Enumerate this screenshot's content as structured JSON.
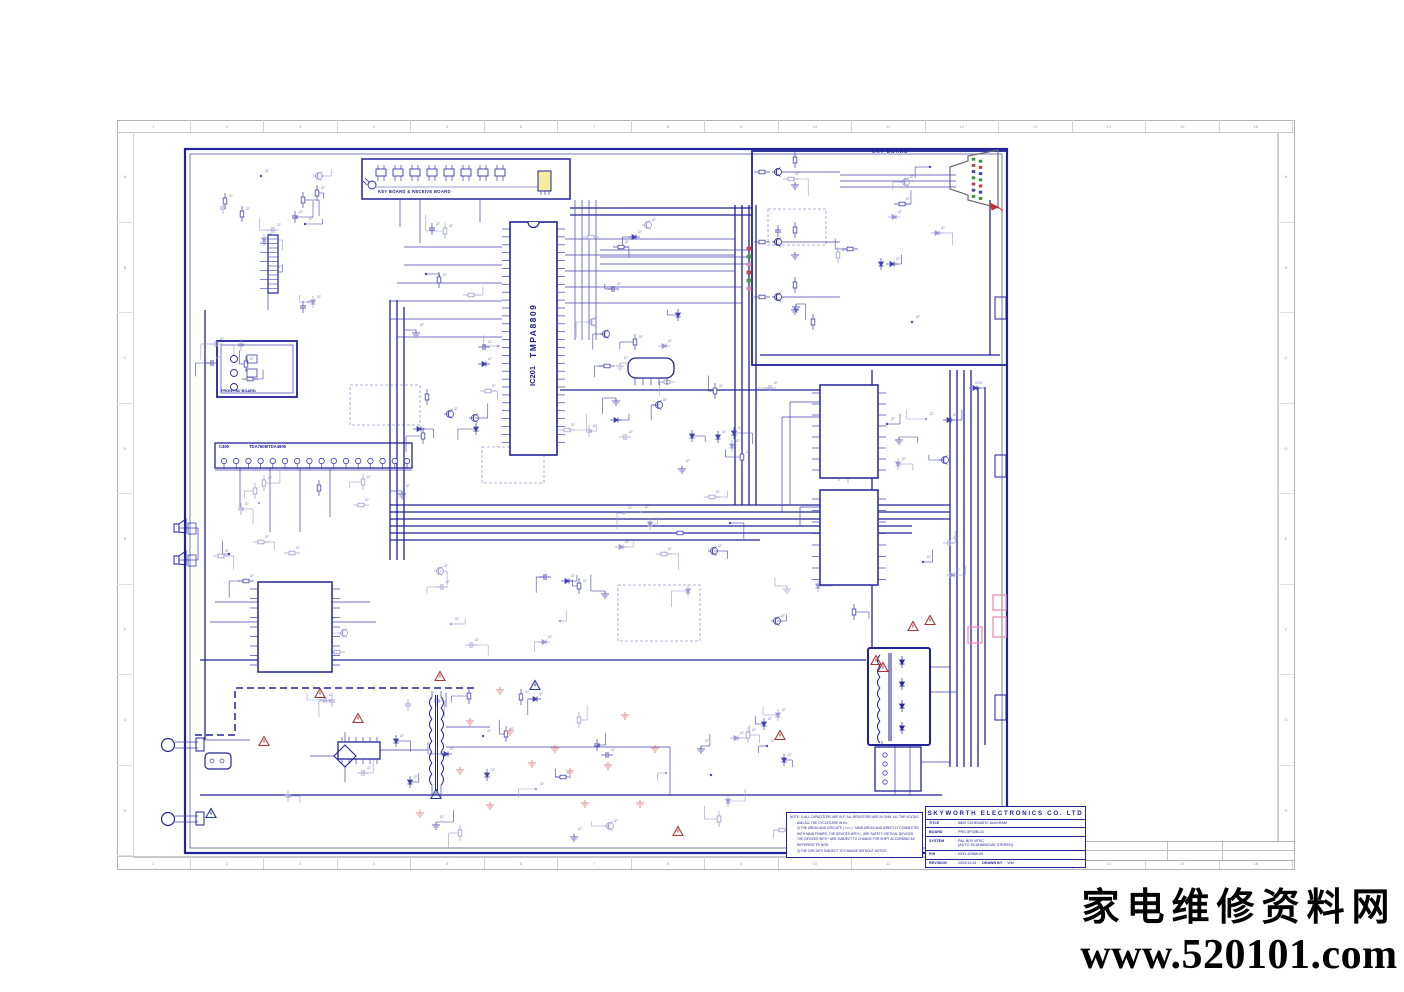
{
  "sheet": {
    "zone_numbers": [
      "1",
      "2",
      "3",
      "4",
      "5",
      "6",
      "7",
      "8",
      "9",
      "10",
      "11",
      "12",
      "13",
      "14",
      "15",
      "16"
    ],
    "zone_letters": [
      "A",
      "B",
      "C",
      "D",
      "E",
      "F",
      "G",
      "H"
    ]
  },
  "labels": {
    "keyboard_board": "KEY BOARD & RECEIVE BOARD",
    "crt_board": "CRT BOARD",
    "ic_ref": "IC201",
    "ic_part": "TMPA8809",
    "front_av_board": "FRONT AV BOARD",
    "audio_conn_ref": "C400",
    "audio_conn_part": "TDA7608/TDA4905"
  },
  "title_block": {
    "company": "SKYWORTH ELECTRONICS CO. LTD",
    "title_label": "TITLE",
    "title_value": "8809 SCHEMATIC DIAGRAM",
    "board_label": "BOARD",
    "board_value": "PRO-5P30B-03",
    "system_label": "SYSTEM",
    "system_value": "PAL BG/I    NTSC",
    "system_value2": "(AUTO SCANNING/AV STEREO)",
    "pn_label": "P/N",
    "pn_value": "0531-42568-00",
    "revision_label": "REVISION",
    "revision_value": "2003/11/15",
    "drawnby_label": "DRAWN BY",
    "drawnby_value": "WM",
    "colon": ":"
  },
  "notes": {
    "lines": [
      "NOTE: 1) ALL CAPACITORS ARE IN P,   ALL RESISTORS ARE IN OHM,   ALL THE VOLTAGES IN V",
      "AND ALL THE CYCLES ARE IN Hz.",
      "2) THE AREAS AND CIRCUITS ( ━━━ ) : MAIN AREAS AND DIRECTLY CONNECTED",
      "WITH MAIN POWER.   THE DEVICES WITH  △  ARE SAFETY CRITICAL DEVICES.",
      "THE DEVICES WITH  *  ARE SUBJECT TO CHANGE FOR SHIPT   ACCORDING   AS",
      "DIFFERENT PS NOR.",
      "3) THE CIRCUITS SUBJECT TO CHANGE WITHOUT NOTICE."
    ]
  },
  "watermark": {
    "line1": "家电维修资料网",
    "line2": "www.520101.com"
  }
}
